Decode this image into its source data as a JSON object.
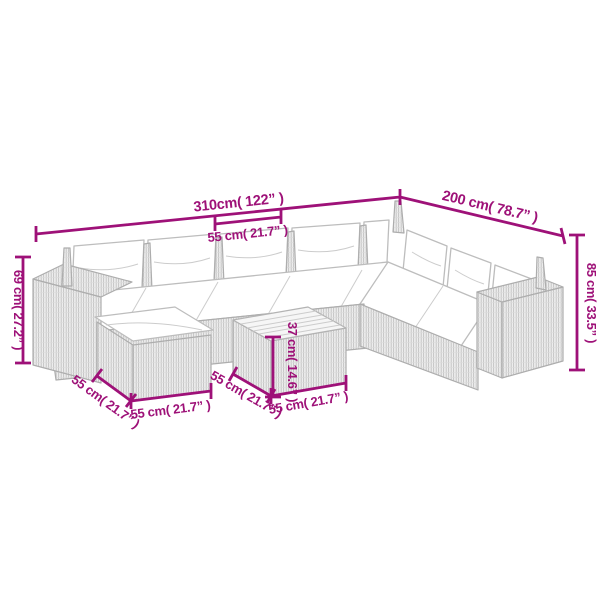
{
  "colors": {
    "accent_magenta": "#9E1178",
    "artwork_gray": "#b3b3b3",
    "background": "#ffffff"
  },
  "dims": {
    "total_width": "310cm( 122” )",
    "total_depth": "200 cm( 78.7” )",
    "seat_width": "55 cm( 21.7” )",
    "sofa_height": "69 cm( 27.2” )",
    "back_height": "85 cm( 33.5” )",
    "table_height": "37 cm( 14.6” )",
    "ottoman_depth": "55 cm( 21.7” )",
    "ottoman_width": "55 cm( 21.7” )",
    "table_depth": "55 cm( 21.7” )",
    "table_width": "55 cm( 21.7” )"
  }
}
